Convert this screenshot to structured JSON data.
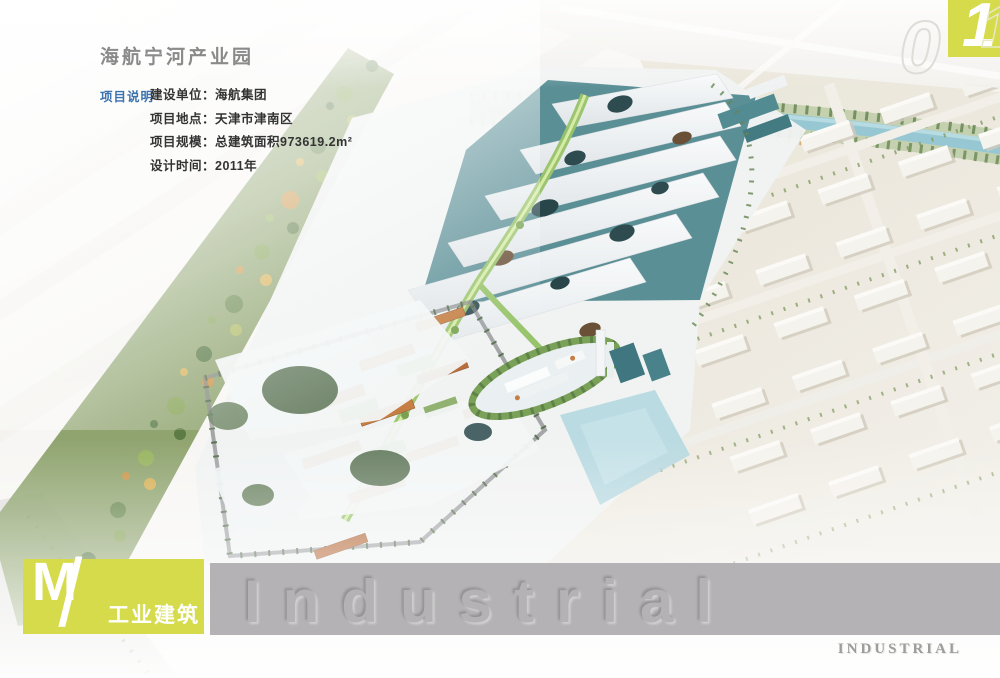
{
  "page": {
    "title": "海航宁河产业园",
    "section_label": "项目说明",
    "project_lines": [
      "建设单位：海航集团",
      "项目地点：天津市津南区",
      "项目规模：总建筑面积973619.2m²",
      "设计时间：2011年"
    ]
  },
  "category": {
    "code": "M",
    "slash": "/",
    "name": "工业建筑"
  },
  "watermark": {
    "embossed": "Industrial",
    "stamp": "INDUSTRIAL"
  },
  "page_number": {
    "zero": "0",
    "one": "1",
    "one_ghost": "1"
  },
  "colors": {
    "accent_green": "#d5db4a",
    "label_blue": "#3c72ae",
    "title_gray": "#8a8a8a",
    "bar_gray": "#b4b2b4",
    "canopy_white": "#f3f6f7",
    "glass_teal": "#44818a",
    "roof_orange": "#b2602c",
    "water_blue": "#9ecbd6",
    "foliage_green": "#7a9454",
    "ground_beige": "#e7e2d4"
  }
}
